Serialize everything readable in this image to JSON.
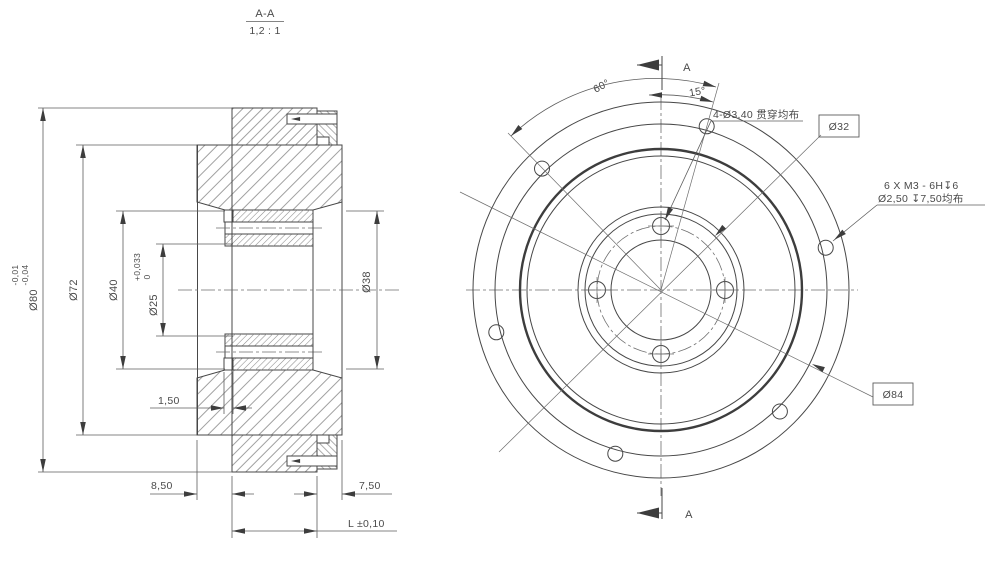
{
  "drawing": {
    "section_title": {
      "label": "A-A",
      "scale": "1,2 : 1"
    },
    "section_view": {
      "dim_d80": "Ø80",
      "d80_tol_up": "-0,01",
      "d80_tol_lo": "-0,04",
      "dim_d72": "Ø72",
      "dim_d40": "Ø40",
      "dim_d25": "Ø25",
      "d25_tol_up": "+0,033",
      "d25_tol_lo": "0",
      "dim_d38": "Ø38",
      "dim_step": "1,50",
      "dim_left_offset": "8,50",
      "dim_right_offset": "7,50",
      "dim_length": "L ±0,10"
    },
    "front_view": {
      "angle_spacing": "60°",
      "angle_offset": "15°",
      "note_through_holes": "4-Ø3,40 贯穿均布",
      "label_d32": "Ø32",
      "label_d84": "Ø84",
      "note_thread_1": "6 X M3 - 6H↧6",
      "note_thread_2": "Ø2,50 ↧7,50均布",
      "section_arrow_top": "A",
      "section_arrow_bottom": "A"
    }
  }
}
